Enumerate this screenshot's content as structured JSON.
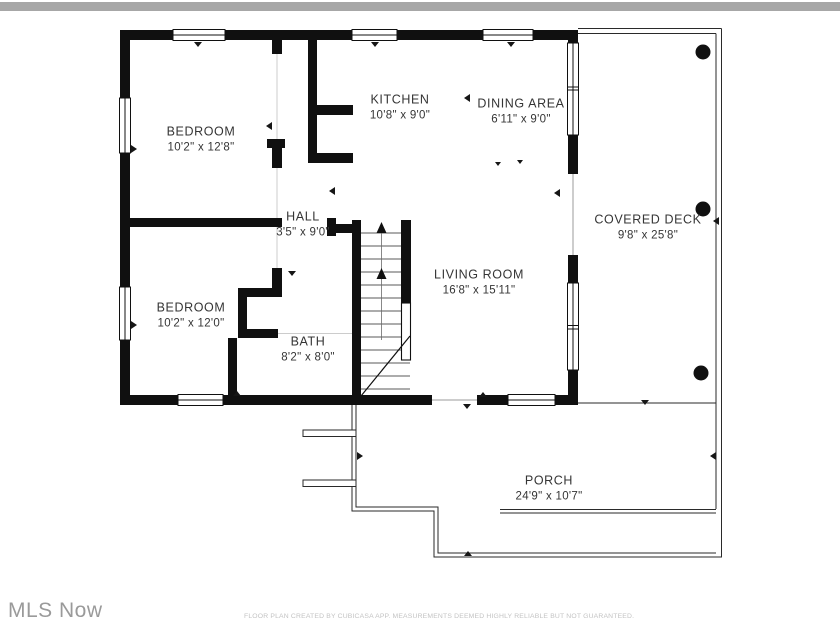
{
  "rooms": {
    "bedroom_top": {
      "name": "BEDROOM",
      "dims": "10'2\" x 12'8\""
    },
    "kitchen": {
      "name": "KITCHEN",
      "dims": "10'8\" x 9'0\""
    },
    "dining": {
      "name": "DINING AREA",
      "dims": "6'11\" x 9'0\""
    },
    "covered_deck": {
      "name": "COVERED DECK",
      "dims": "9'8\" x 25'8\""
    },
    "hall": {
      "name": "HALL",
      "dims": "3'5\" x 9'0\""
    },
    "living": {
      "name": "LIVING ROOM",
      "dims": "16'8\" x 15'11\""
    },
    "bedroom_bottom": {
      "name": "BEDROOM",
      "dims": "10'2\" x 12'0\""
    },
    "bath": {
      "name": "BATH",
      "dims": "8'2\" x 8'0\""
    },
    "porch": {
      "name": "PORCH",
      "dims": "24'9\" x 10'7\""
    }
  },
  "watermark": {
    "text": "MLS Now"
  },
  "footer": {
    "text": "FLOOR PLAN CREATED BY CUBICASA APP. MEASUREMENTS DEEMED HIGHLY RELIABLE BUT NOT GUARANTEED."
  },
  "colors": {
    "wall": "#101010",
    "top_bar": "#a7a7a7",
    "label_text": "#353535",
    "watermark_text": "#9a9a9a",
    "footer_text": "#c3c3c3",
    "thin_outline": "#2a2a2a"
  }
}
